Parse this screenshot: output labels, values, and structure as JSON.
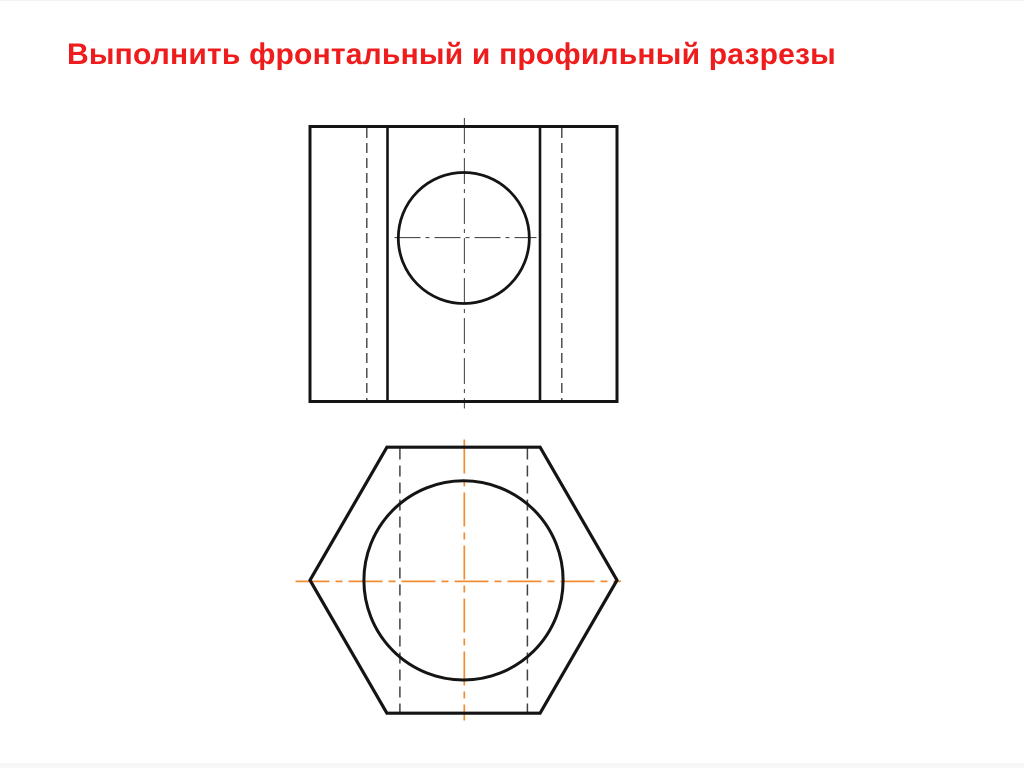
{
  "slide": {
    "title": "Выполнить фронтальный и профильный разрезы",
    "colors": {
      "title_red": "#ee1c1c",
      "background": "#ffffff",
      "outline_black": "#141414",
      "hidden_line_gray": "#424242",
      "center_line_gray": "#4d4d4d",
      "center_line_orange": "#f08c32",
      "page_edge_gray": "#f7f7f7"
    }
  }
}
